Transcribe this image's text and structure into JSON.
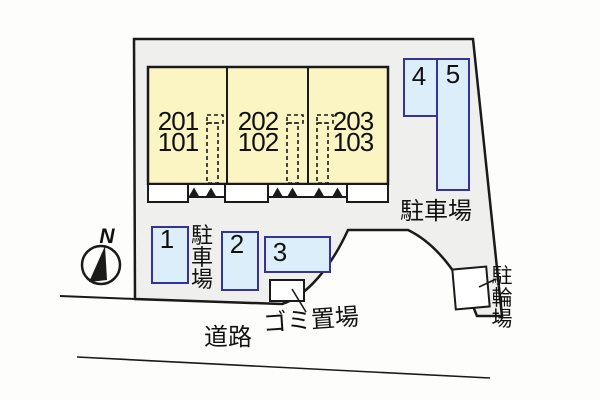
{
  "colors": {
    "page_bg": "#FDFDFB",
    "site_fill": "#EFEFED",
    "room_fill": "#FBF4C3",
    "parking_fill": "#DCEEF9",
    "parking_border": "#333399",
    "line": "#1A1A1A",
    "text": "#111111",
    "box_fill": "#FFFFFF"
  },
  "compass": {
    "north_label": "N"
  },
  "building": {
    "units": [
      {
        "upper": "201",
        "lower": "101"
      },
      {
        "upper": "202",
        "lower": "102"
      },
      {
        "upper": "203",
        "lower": "103"
      }
    ]
  },
  "parking": {
    "area_right_label": "駐車場",
    "area_left_label": "駐車場",
    "space_numbers": [
      "1",
      "2",
      "3",
      "4",
      "5"
    ]
  },
  "bicycle_parking": {
    "label": "駐輪場"
  },
  "garbage_area": {
    "label": "ゴミ置場"
  },
  "road": {
    "label": "道路"
  }
}
